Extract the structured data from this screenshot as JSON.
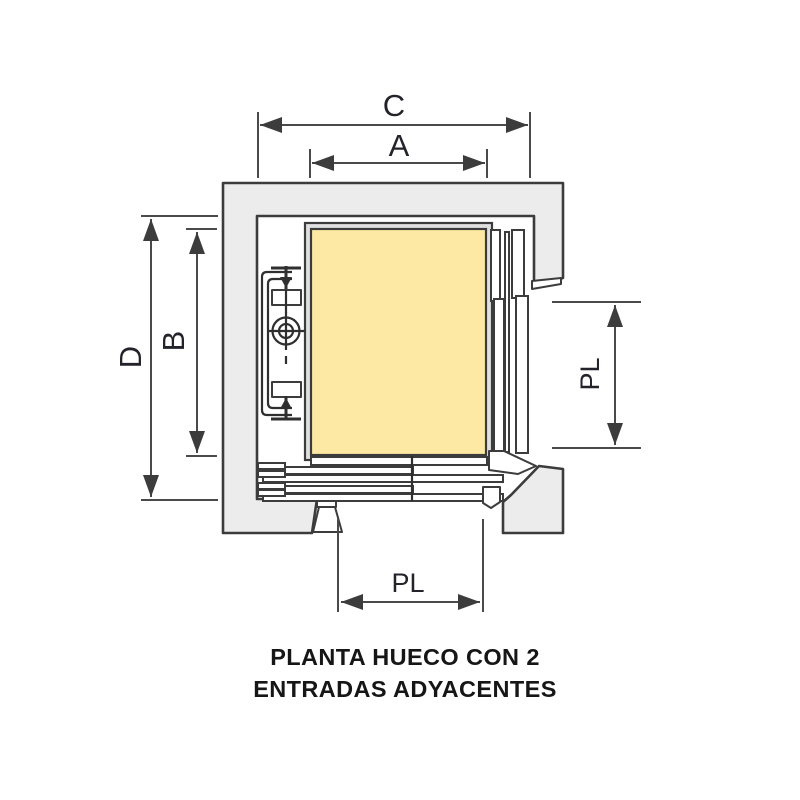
{
  "diagram": {
    "type": "elevator-shaft-plan",
    "dimensions": {
      "c": "C",
      "a": "A",
      "d": "D",
      "b": "B",
      "pl_right": "PL",
      "pl_bottom": "PL"
    },
    "title_line1": "PLANTA HUECO CON 2",
    "title_line2": "ENTRADAS ADYACENTES",
    "colors": {
      "background": "#ffffff",
      "wall_fill": "#ececec",
      "outline": "#3c3c3c",
      "cabin_fill": "#fde9a3",
      "cabin_frame": "#e0e0e0",
      "dimension_line": "#4a4a4a",
      "label_text": "#23232b",
      "title_text": "#161616"
    }
  }
}
